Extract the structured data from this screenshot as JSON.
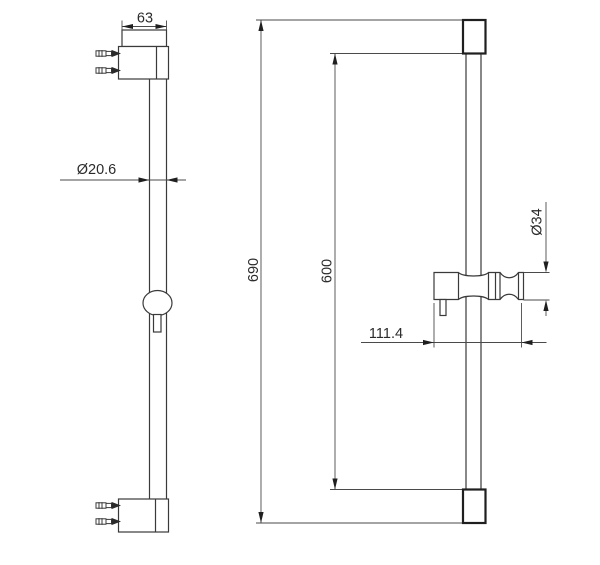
{
  "drawing": {
    "subject": "shower slide bar technical drawing, two orthographic views",
    "colors": {
      "background": "#ffffff",
      "object_line": "#3a3a3a",
      "dimension_line": "#4a4a4a",
      "text": "#2b2b2b"
    },
    "dimensions": {
      "bracket_width": "63",
      "bar_diameter": "Ø20.6",
      "overall_length": "690",
      "rail_length": "600",
      "holder_diameter": "Ø34",
      "holder_length": "111.4"
    }
  }
}
